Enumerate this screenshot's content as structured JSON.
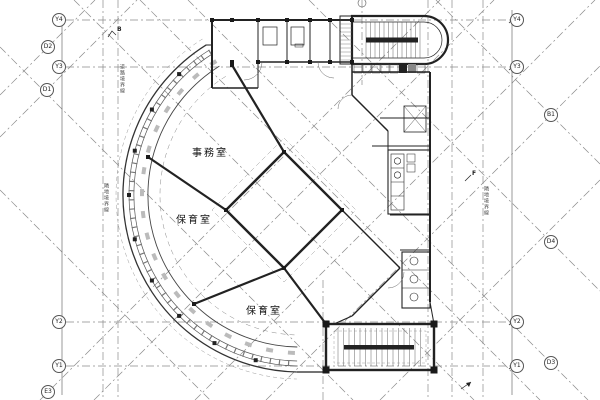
{
  "rooms": [
    {
      "label": "事務室"
    },
    {
      "label": "保育室"
    },
    {
      "label": "保育室"
    }
  ],
  "grid": {
    "left": [
      {
        "label": "Y4"
      },
      {
        "label": "D2"
      },
      {
        "label": "Y3"
      },
      {
        "label": "D1"
      },
      {
        "label": "Y2"
      },
      {
        "label": "Y1"
      },
      {
        "label": "E3"
      }
    ],
    "right": [
      {
        "label": "Y4"
      },
      {
        "label": "Y3"
      },
      {
        "label": "B1"
      },
      {
        "label": "D4"
      },
      {
        "label": "Y2"
      },
      {
        "label": "Y1"
      },
      {
        "label": "D3"
      }
    ]
  },
  "boundaries": {
    "left_upper": "道路境界線",
    "left_mid": "隣地境界線",
    "right_mid": "隣地境界線"
  },
  "marks": {
    "b": "B",
    "f": "F"
  },
  "colors": {
    "wall": "#222222",
    "grid_line": "#8a8a8a",
    "glazing": "#555555"
  }
}
